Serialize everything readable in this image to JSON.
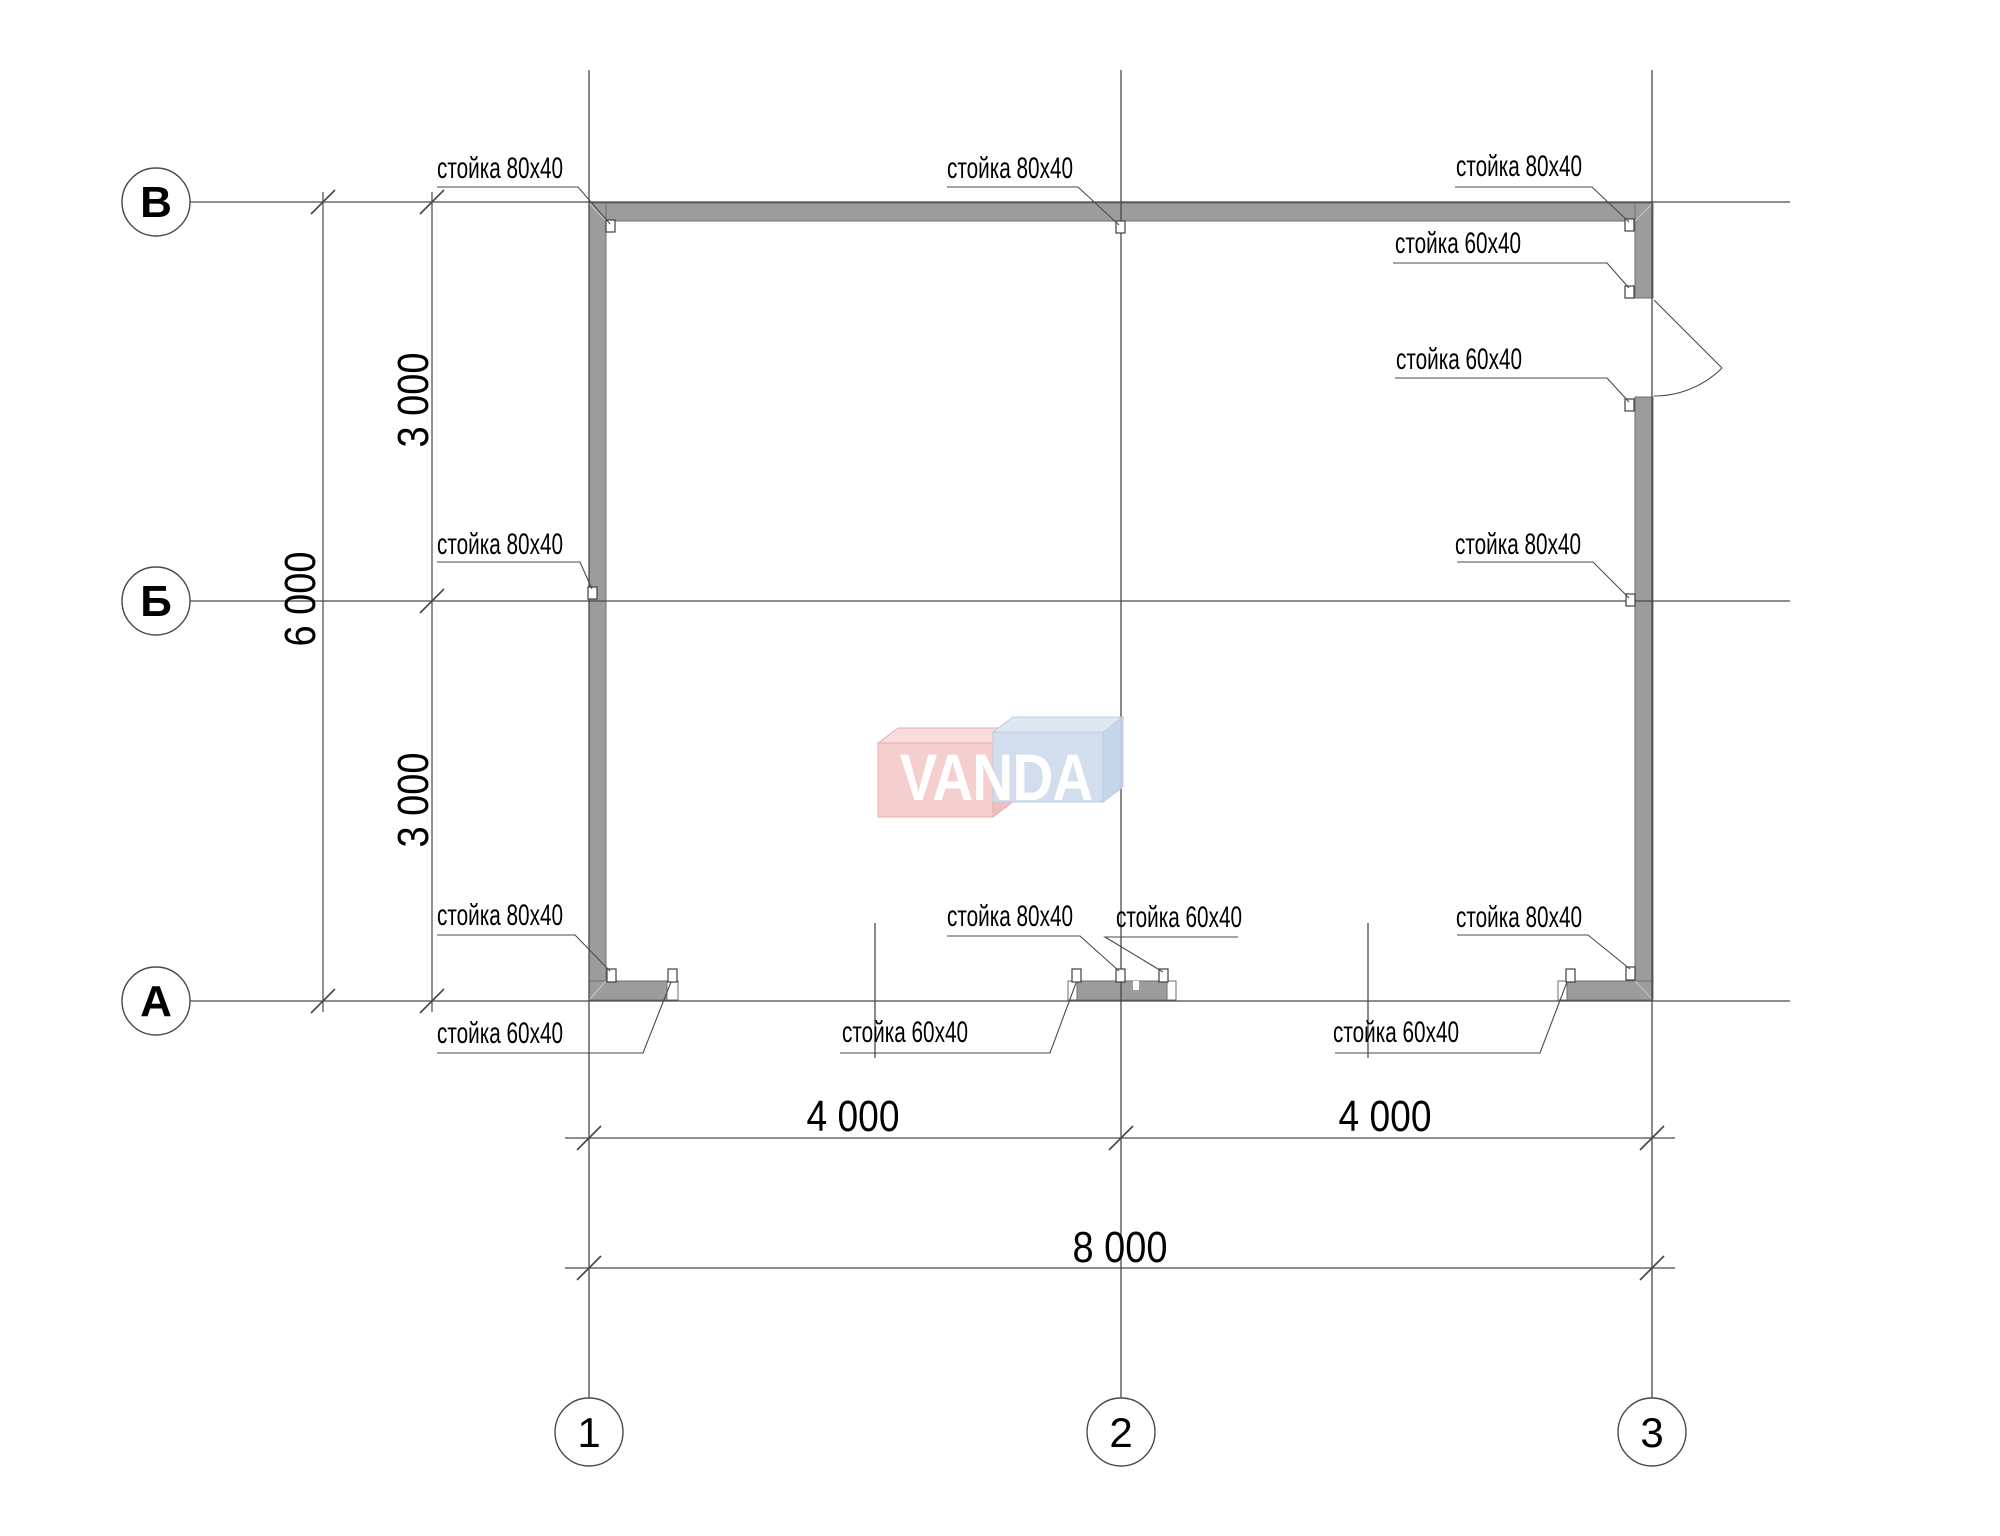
{
  "axes": {
    "rows": [
      {
        "label": "В"
      },
      {
        "label": "Б"
      },
      {
        "label": "А"
      }
    ],
    "cols": [
      {
        "label": "1"
      },
      {
        "label": "2"
      },
      {
        "label": "3"
      }
    ]
  },
  "dimensions": {
    "left_span_top": "3 000",
    "left_span_bottom": "3 000",
    "left_total": "6 000",
    "bottom_span_left": "4 000",
    "bottom_span_right": "4 000",
    "bottom_total": "8 000"
  },
  "stud_labels": {
    "top_left": "стойка 80х40",
    "top_mid": "стойка 80х40",
    "top_right": "стойка 80х40",
    "door_upper": "стойка 60х40",
    "door_lower": "стойка 60х40",
    "mid_left": "стойка 80х40",
    "mid_right": "стойка 80х40",
    "bottom_left_80": "стойка 80х40",
    "bottom_mid_80": "стойка 80х40",
    "bottom_mid_60": "стойка 60х40",
    "bottom_right_80": "стойка 80х40",
    "sill_left_60": "стойка 60х40",
    "sill_mid_60": "стойка 60х40",
    "sill_right_60": "стойка 60х40"
  },
  "logo": {
    "text": "VANDA",
    "red_front": "#f5caca",
    "red_top": "#f8d9d9",
    "red_side": "#eeb9b9",
    "red_stroke": "#e7a9a9",
    "blue_front": "#cfdcec",
    "blue_top": "#dde6f2",
    "blue_side": "#c2d2e6",
    "blue_stroke": "#b7c9de"
  },
  "colors": {
    "wall": "#9c9c9c",
    "line": "#4a4a4a"
  }
}
